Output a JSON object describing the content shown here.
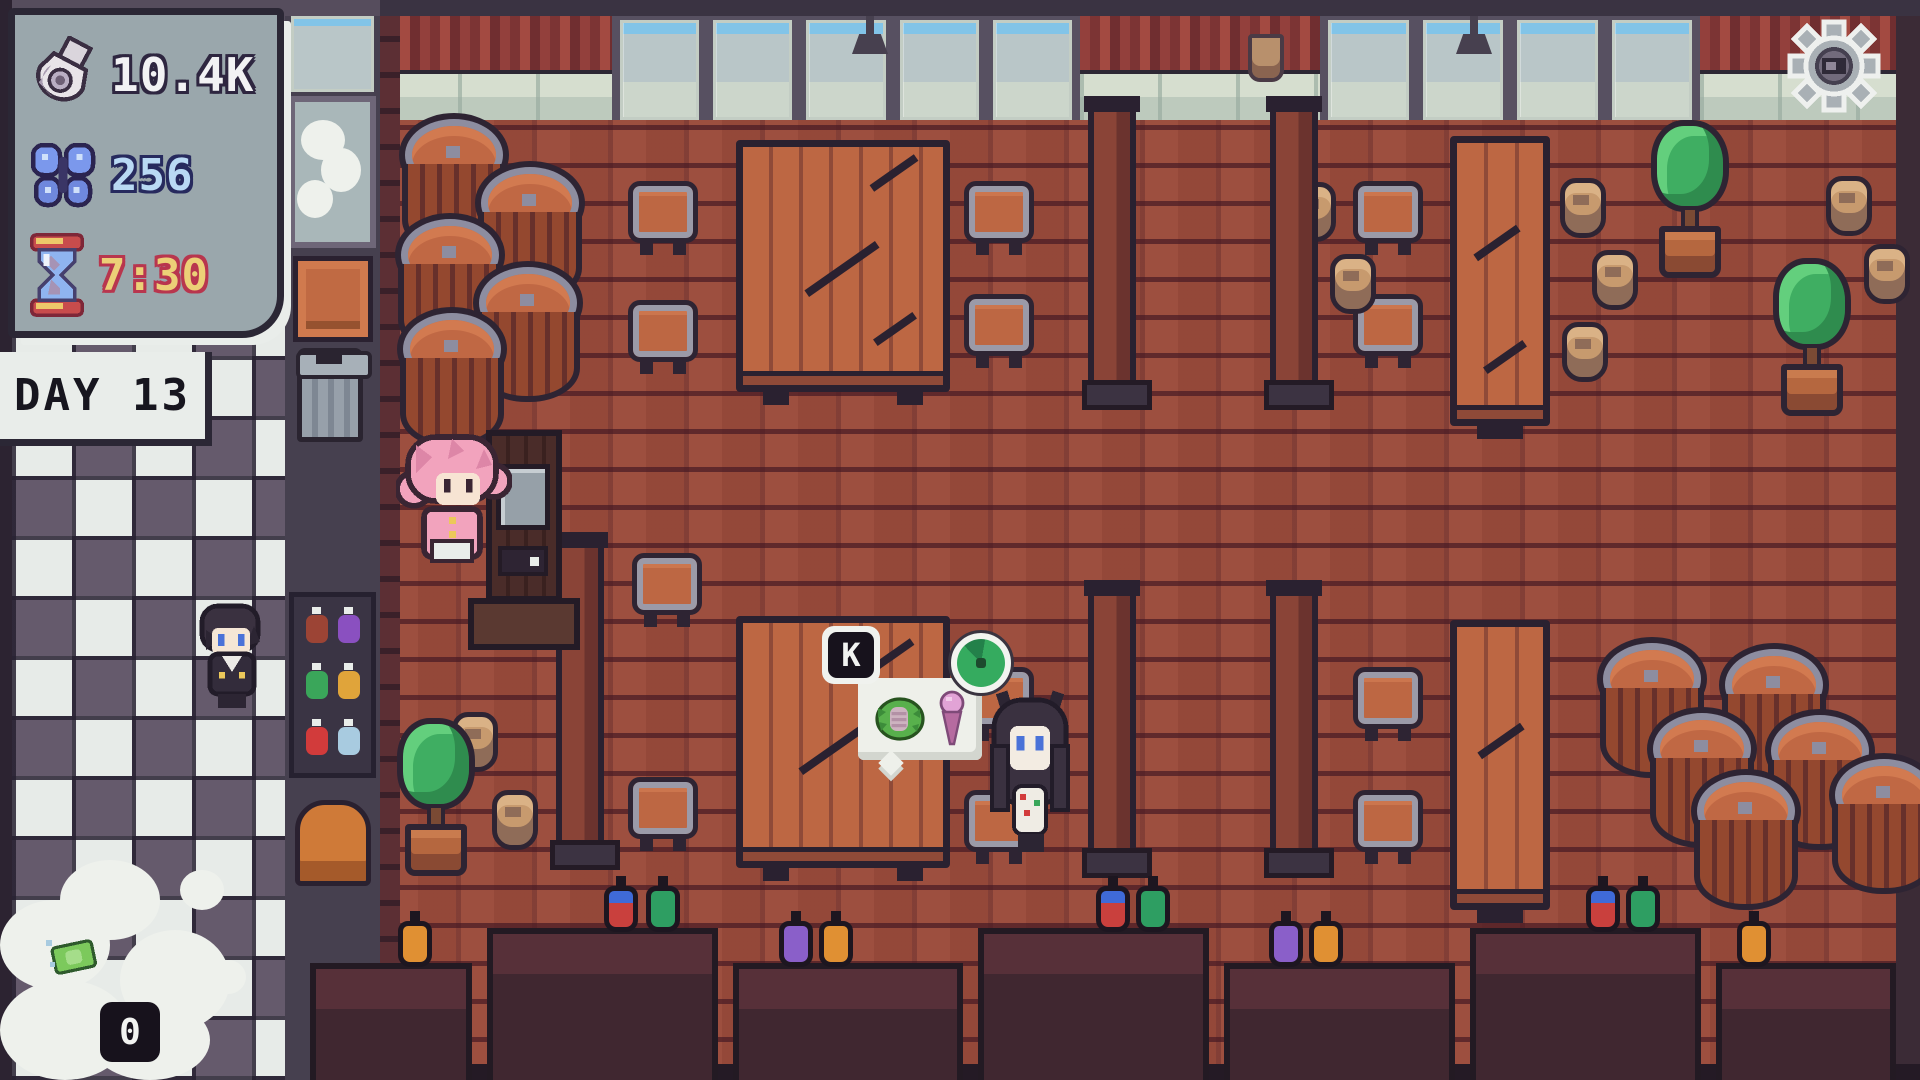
{
  "hud": {
    "money": {
      "icon": "money-bag-icon",
      "value": "10.4K",
      "text_color": "#f2f2f4",
      "outline_color": "#2e2640"
    },
    "butterflies": {
      "icon": "butterfly-icon",
      "value": "256",
      "text_color": "#b9d9f4",
      "outline_color": "#272a5e"
    },
    "timer": {
      "icon": "hourglass-icon",
      "value": "7:30",
      "text_color": "#ecd077",
      "outline_color": "#b8364e"
    },
    "day_banner": {
      "label": "DAY 13"
    },
    "dish_counter": {
      "icon": "cash-icon",
      "value": "0"
    }
  },
  "order_prompt": {
    "key": "K",
    "items": [
      "lettuce-wrap-icon",
      "ice-cream-icon"
    ],
    "timer_icon": "order-timer-icon",
    "timer_fill_percent": 85,
    "timer_color": "#35ab5f"
  },
  "settings": {
    "icon": "gear-icon"
  },
  "scene": {
    "location": "tavern-dining-room",
    "characters": [
      "player-pink-hair",
      "customer-black-hair",
      "worker-black-hair"
    ],
    "props": [
      "barrels",
      "stools",
      "plank-tables",
      "long-tables",
      "potted-trees",
      "clay-jugs",
      "pillars",
      "bottle-cabinet",
      "trash-can",
      "crate",
      "sink-station",
      "cash-register",
      "bar-counters",
      "potion-bottles"
    ]
  },
  "colors": {
    "hud_panel": "#9aa7ac",
    "hud_border": "#2b2735",
    "brick_floor": "#9d4f3f",
    "wall_plank_red": "#93403c",
    "checker_dark": "#655a6c",
    "checker_light": "#e7ebe8",
    "wood_furniture": "#bd6743",
    "counter_dark": "#402730",
    "order_timer_green": "#35ab5f"
  }
}
